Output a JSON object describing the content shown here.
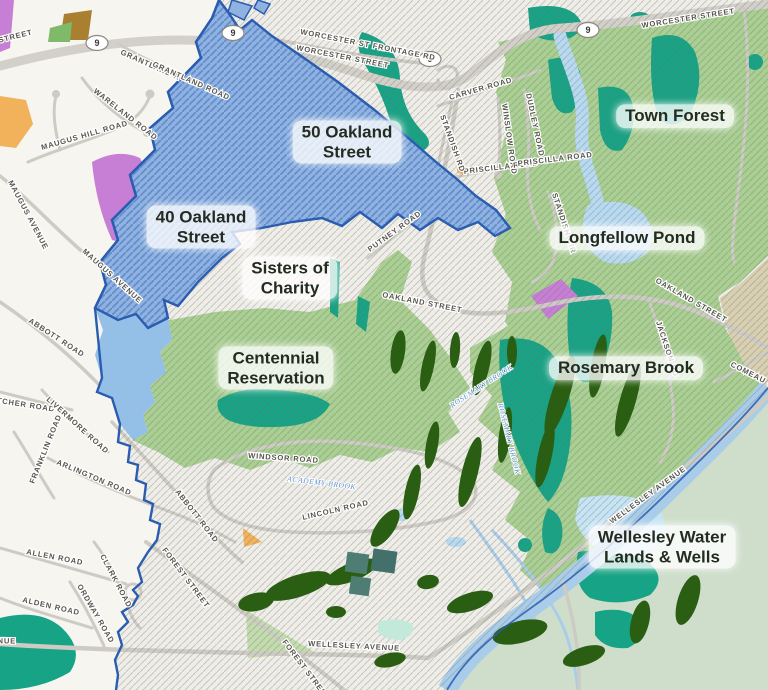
{
  "map": {
    "area_labels": [
      {
        "id": "oakland-40",
        "lines": [
          "40 Oakland",
          "Street"
        ]
      },
      {
        "id": "oakland-50",
        "lines": [
          "50 Oakland",
          "Street"
        ]
      },
      {
        "id": "sisters-of-charity",
        "lines": [
          "Sisters of",
          "Charity"
        ]
      },
      {
        "id": "centennial-reservation",
        "lines": [
          "Centennial",
          "Reservation"
        ]
      },
      {
        "id": "town-forest",
        "lines": [
          "Town Forest"
        ]
      },
      {
        "id": "longfellow-pond",
        "lines": [
          "Longfellow Pond"
        ]
      },
      {
        "id": "rosemary-brook",
        "lines": [
          "Rosemary Brook"
        ]
      },
      {
        "id": "wellesley-water",
        "lines": [
          "Wellesley Water",
          "Lands & Wells"
        ]
      }
    ],
    "streets": [
      {
        "text": "WASHINGTON STREET"
      },
      {
        "text": "WORCESTER ST FRONTAGE RD"
      },
      {
        "text": "WORCESTER STREET"
      },
      {
        "text": "WORCESTER STREET"
      },
      {
        "text": "GRANTLAND R"
      },
      {
        "text": "GRANTLAND ROAD"
      },
      {
        "text": "WARELAND ROAD"
      },
      {
        "text": "MAUGUS HILL ROAD"
      },
      {
        "text": "MAUGUS AVENUE"
      },
      {
        "text": "MAUGUS AVENUE"
      },
      {
        "text": "ABBOTT ROAD"
      },
      {
        "text": "FLETCHER ROAD"
      },
      {
        "text": "LIVERMORE ROAD"
      },
      {
        "text": "FRANKLIN ROAD"
      },
      {
        "text": "ARLINGTON ROAD"
      },
      {
        "text": "ALLEN ROAD"
      },
      {
        "text": "CLARK ROAD"
      },
      {
        "text": "ORDWAY ROAD"
      },
      {
        "text": "ALDEN ROAD"
      },
      {
        "text": "WELLESLEY AVENUE"
      },
      {
        "text": "FOREST STREET"
      },
      {
        "text": "ABBOTT ROAD"
      },
      {
        "text": "FOREST STREET"
      },
      {
        "text": "WINDSOR ROAD"
      },
      {
        "text": "LINCOLN ROAD"
      },
      {
        "text": "WELLESLEY AVENUE"
      },
      {
        "text": "WELLESLEY AVENUE"
      },
      {
        "text": "OAKLAND STREET"
      },
      {
        "text": "OAKLAND STREET"
      },
      {
        "text": "PUTNEY ROAD"
      },
      {
        "text": "CARVER ROAD"
      },
      {
        "text": "WINSLOW ROAD"
      },
      {
        "text": "DUDLEY ROAD"
      },
      {
        "text": "PRISCILLA ROAD"
      },
      {
        "text": "PRISCILLA ROAD"
      },
      {
        "text": "STANDISH RD"
      },
      {
        "text": "STANDISH CIR"
      },
      {
        "text": "JACKSON RD"
      },
      {
        "text": "COMEAU ST"
      }
    ],
    "water_labels": [
      {
        "text": "ACADEMY BROOK"
      },
      {
        "text": "ROSEMARY BROOK"
      },
      {
        "text": "ROSEMARY BROOK"
      }
    ],
    "routes": [
      {
        "number": "9"
      },
      {
        "number": "9"
      },
      {
        "number": "9"
      },
      {
        "number": "9"
      }
    ],
    "colors": {
      "land_west": "#f7f5f0",
      "land_hatched": "#efede7",
      "hatch_line": "#6e6e69",
      "parcel_blue": "#8fb2e0",
      "parcel_hatch": "#3f6fba",
      "parcel_border": "#2a5cb0",
      "parcel_blue_solid": "#94c0e8",
      "forest_green": "#a9cf92",
      "pale_green": "#c3dcae",
      "sage_green": "#cfdecb",
      "tan": "#d9d0b2",
      "wetland_teal": "#17a385",
      "golf_green": "#2a5e12",
      "water_blue": "#b8daf1",
      "river_blue": "#a9cde9",
      "purple": "#c77fd6",
      "orange": "#f2b25c",
      "brown": "#a8802f",
      "road_gray": "#cdcbc4",
      "label_dark": "#242c22",
      "street_label_gray": "#57554e"
    }
  }
}
